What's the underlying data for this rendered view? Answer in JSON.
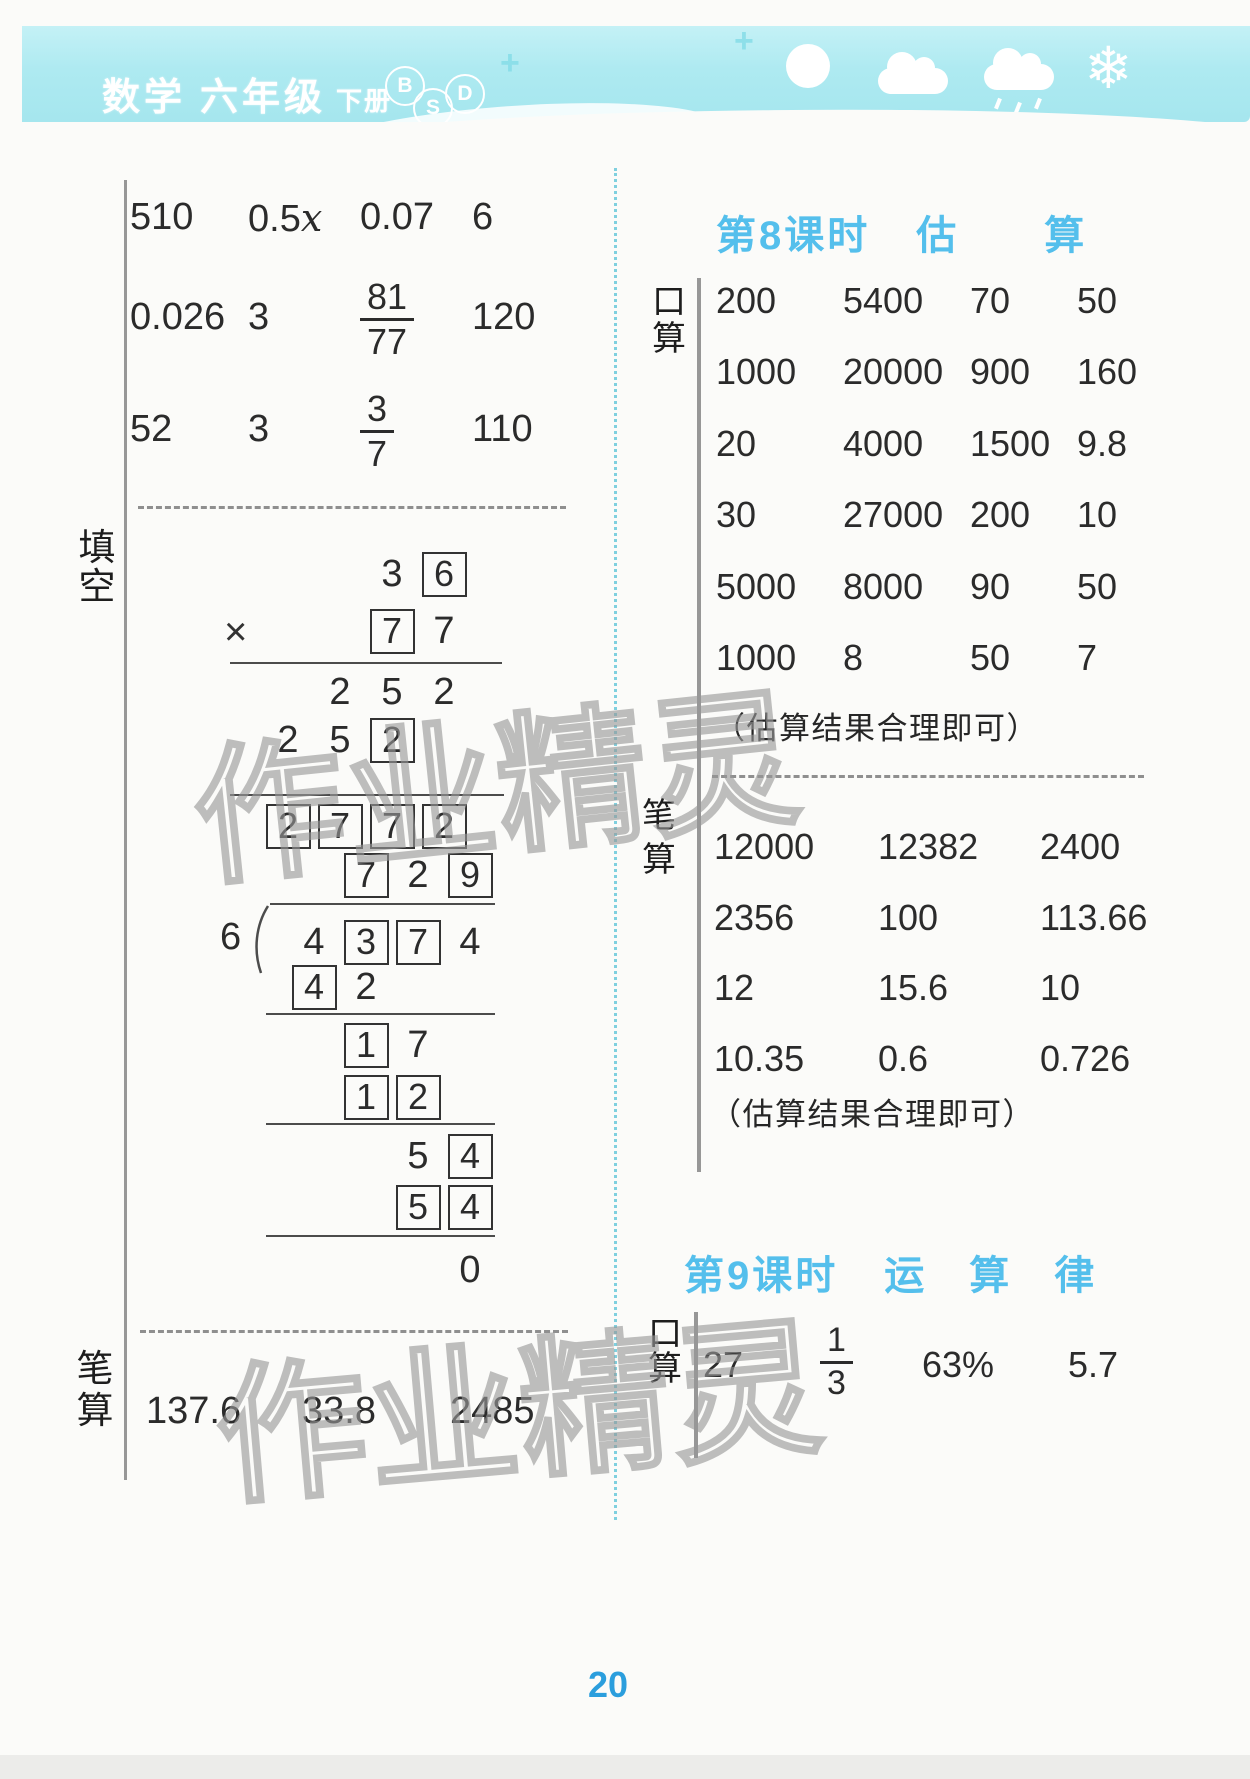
{
  "header": {
    "subject": "数学",
    "grade": "六年级",
    "volume": "下册",
    "logo_letters": [
      "B",
      "S",
      "D"
    ],
    "snowflake_glyph": "❄",
    "plus_glyph": "+"
  },
  "watermark": "作业精灵",
  "page_number": "20",
  "left_column": {
    "label_fill_blank": "填空",
    "label_written_calc": "笔算",
    "answer_rows": [
      [
        {
          "t": "510"
        },
        {
          "t": "0.5",
          "var": "x"
        },
        {
          "t": "0.07"
        },
        {
          "t": "6"
        }
      ],
      [
        {
          "t": "0.026"
        },
        {
          "t": "3"
        },
        {
          "n": "81",
          "d": "77"
        },
        {
          "t": "120"
        }
      ],
      [
        {
          "t": "52"
        },
        {
          "t": "3"
        },
        {
          "n": "3",
          "d": "7"
        },
        {
          "t": "110"
        }
      ]
    ],
    "multiplication": {
      "op_sign": "×",
      "rows": [
        [
          "",
          "",
          "3",
          "[6]"
        ],
        [
          "",
          "",
          "[7]",
          "7"
        ],
        [
          "",
          "2",
          "5",
          "2"
        ],
        [
          "2",
          "5",
          "[2]",
          ""
        ],
        [
          "[2]",
          "[7]",
          "[7]",
          "[2]"
        ]
      ]
    },
    "division": {
      "divisor": "6",
      "quotient_row": [
        "",
        "[7]",
        "2",
        "[9]"
      ],
      "dividend_row": [
        "4",
        "[3]",
        "[7]",
        "4"
      ],
      "work_rows": [
        [
          "[4]",
          "2",
          "",
          ""
        ],
        [
          "",
          "[1]",
          "7",
          ""
        ],
        [
          "",
          "[1]",
          "[2]",
          ""
        ],
        [
          "",
          "",
          "5",
          "[4]"
        ],
        [
          "",
          "",
          "[5]",
          "[4]"
        ],
        [
          "",
          "",
          "",
          "0"
        ]
      ]
    },
    "written_values": [
      [
        "137.6",
        "33.8",
        "2485"
      ]
    ]
  },
  "right_column": {
    "lesson8": {
      "lesson_label": "第8课时",
      "title_chars": [
        "估",
        "算"
      ],
      "oral_label": "口算",
      "oral_rows": [
        [
          "200",
          "5400",
          "70",
          "50"
        ],
        [
          "1000",
          "20000",
          "900",
          "160"
        ],
        [
          "20",
          "4000",
          "1500",
          "9.8"
        ],
        [
          "30",
          "27000",
          "200",
          "10"
        ],
        [
          "5000",
          "8000",
          "90",
          "50"
        ],
        [
          "1000",
          "8",
          "50",
          "7"
        ]
      ],
      "oral_note": "（估算结果合理即可）",
      "written_label": "笔算",
      "written_rows": [
        [
          "12000",
          "12382",
          "2400"
        ],
        [
          "2356",
          "100",
          "113.66"
        ],
        [
          "12",
          "15.6",
          "10"
        ],
        [
          "10.35",
          "0.6",
          "0.726"
        ]
      ],
      "written_note": "（估算结果合理即可）"
    },
    "lesson9": {
      "lesson_label": "第9课时",
      "title_chars": [
        "运",
        "算",
        "律"
      ],
      "oral_label": "口算",
      "answer_row": [
        {
          "t": "27"
        },
        {
          "n": "1",
          "d": "3"
        },
        {
          "t": "63%"
        },
        {
          "t": "5.7"
        }
      ]
    }
  }
}
